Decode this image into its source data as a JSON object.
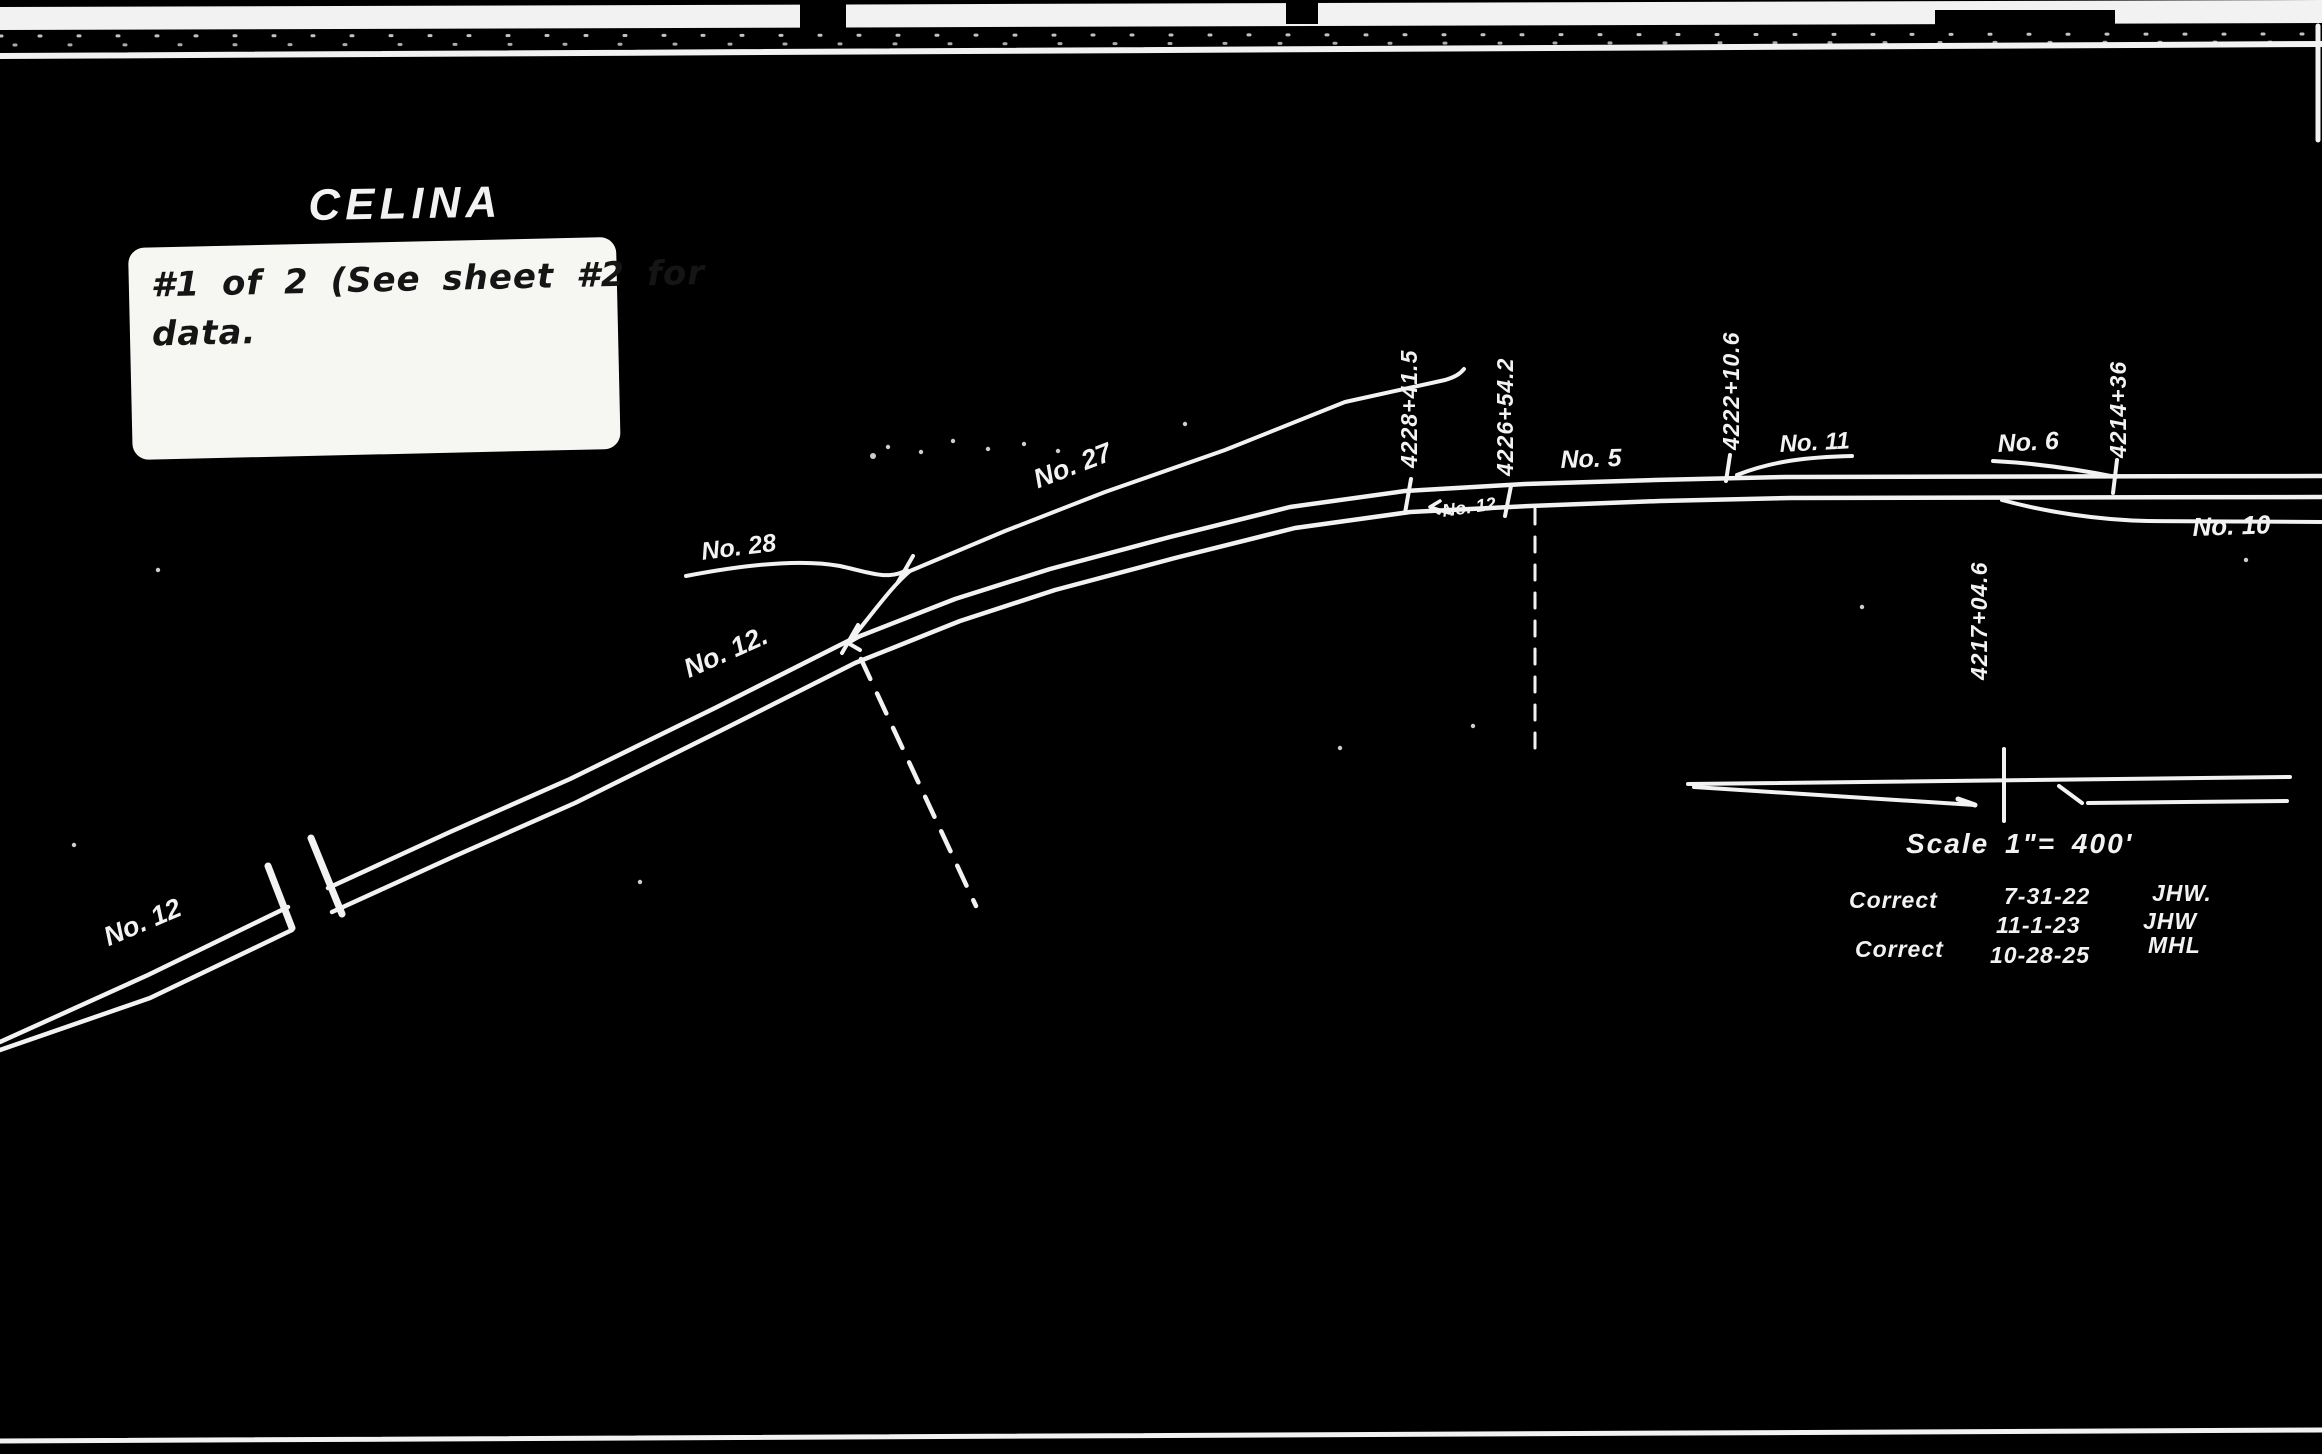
{
  "colors": {
    "background": "#000000",
    "ink": "#f2f2f2",
    "note_bg": "#f6f6f3",
    "note_ink": "#151515"
  },
  "title": "CELINA",
  "note": [
    "#1 of 2 (See sheet #2 for",
    "data."
  ],
  "track_labels": {
    "no27": "No. 27",
    "no28": "No. 28",
    "no12_mid": "No. 12.",
    "no12_corner": "No. 12",
    "no12_switch": "No. 12",
    "no5": "No. 5",
    "no11": "No. 11",
    "no6": "No. 6",
    "no10": "No. 10"
  },
  "stations": [
    "4228+41.5",
    "4226+54.2",
    "4222+10.6",
    "4214+36",
    "4217+04.6"
  ],
  "scale_label": "Scale 1\"= 400'",
  "corrections": [
    {
      "action": "Correct",
      "date": "7-31-22",
      "initials": "JHW."
    },
    {
      "action": "",
      "date": "11-1-23",
      "initials": "JHW"
    },
    {
      "action": "Correct",
      "date": "10-28-25",
      "initials": "MHL"
    }
  ]
}
